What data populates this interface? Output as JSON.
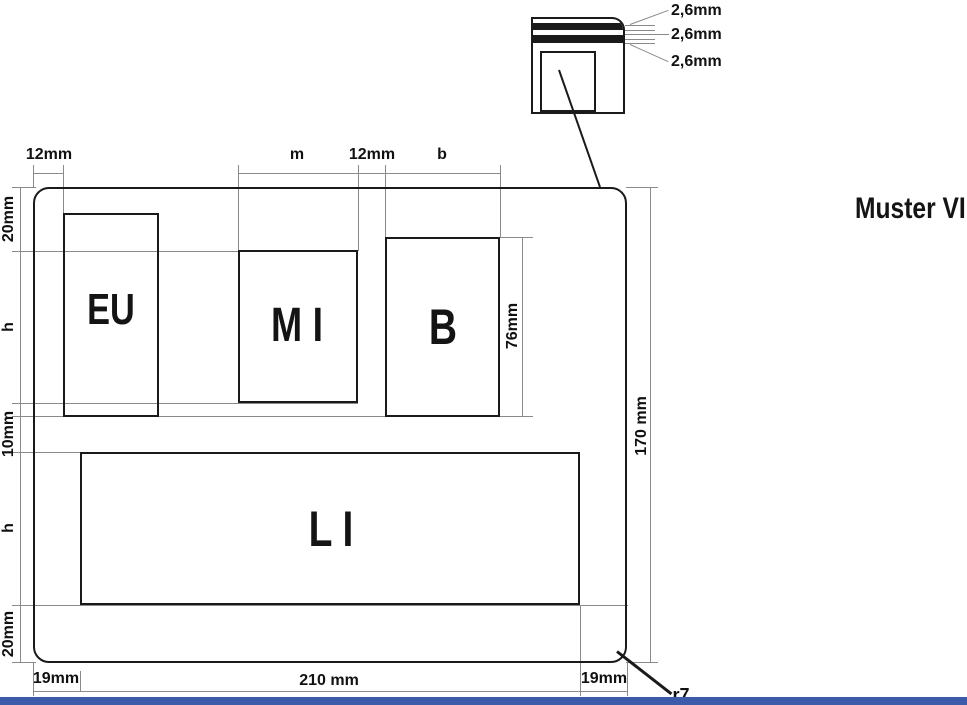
{
  "title": "Muster VIII",
  "plate_fields": {
    "eu": "EU",
    "mi": "M I",
    "b": "B",
    "li": "L I"
  },
  "dimensions": {
    "top": {
      "left_margin": "12mm",
      "m_width": "m",
      "middle_gap": "12mm",
      "b_width": "b"
    },
    "left": {
      "top_margin": "20mm",
      "row1_height": "h",
      "row_gap": "10mm",
      "row2_height": "h",
      "bottom_margin": "20mm"
    },
    "right": {
      "plate_height": "170 mm"
    },
    "bottom": {
      "left_margin": "19mm",
      "plate_width": "210 mm",
      "right_margin": "19mm"
    },
    "b_field_height": "76mm",
    "corner_radius": "r7"
  },
  "detail": {
    "layer1_thickness": "2,6mm",
    "layer2_thickness": "2,6mm",
    "layer3_thickness": "2,6mm"
  },
  "colors": {
    "object_line": "#1a1a1a",
    "dimension_line": "#8a8a8a",
    "bottom_bar": "#3c5ba8"
  }
}
